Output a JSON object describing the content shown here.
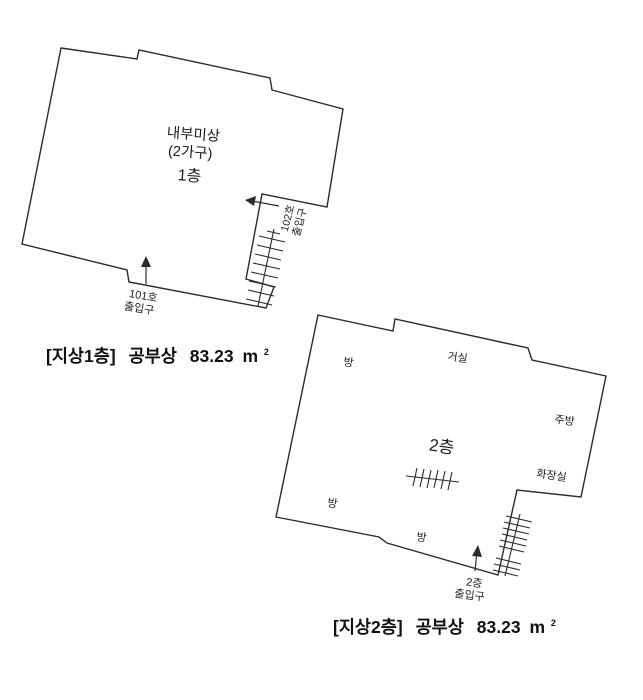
{
  "page_title": "건물 평면도 (지상1층 / 지상2층)",
  "colors": {
    "background": "#ffffff",
    "line": "#2b2b2b",
    "text": "#1c1c1c"
  },
  "floor1": {
    "labels": {
      "interior": "내부미상",
      "households": "(2가구)",
      "floor": "1층",
      "entrance101_line1": "101호",
      "entrance101_line2": "출입구",
      "entrance102_line1": "102호",
      "entrance102_line2": "출입구"
    },
    "caption": {
      "bracket": "[지상1층]",
      "name": "공부상",
      "area_value": "83.23",
      "area_unit": "m",
      "area_unit_sup": "2"
    }
  },
  "floor2": {
    "labels": {
      "room_top_left": "방",
      "living_room": "거실",
      "kitchen": "주방",
      "bathroom": "화장실",
      "floor": "2층",
      "room_left": "방",
      "room_bottom": "방",
      "entrance_line1": "2층",
      "entrance_line2": "출입구"
    },
    "caption": {
      "bracket": "[지상2층]",
      "name": "공부상",
      "area_value": "83.23",
      "area_unit": "m",
      "area_unit_sup": "2"
    }
  }
}
